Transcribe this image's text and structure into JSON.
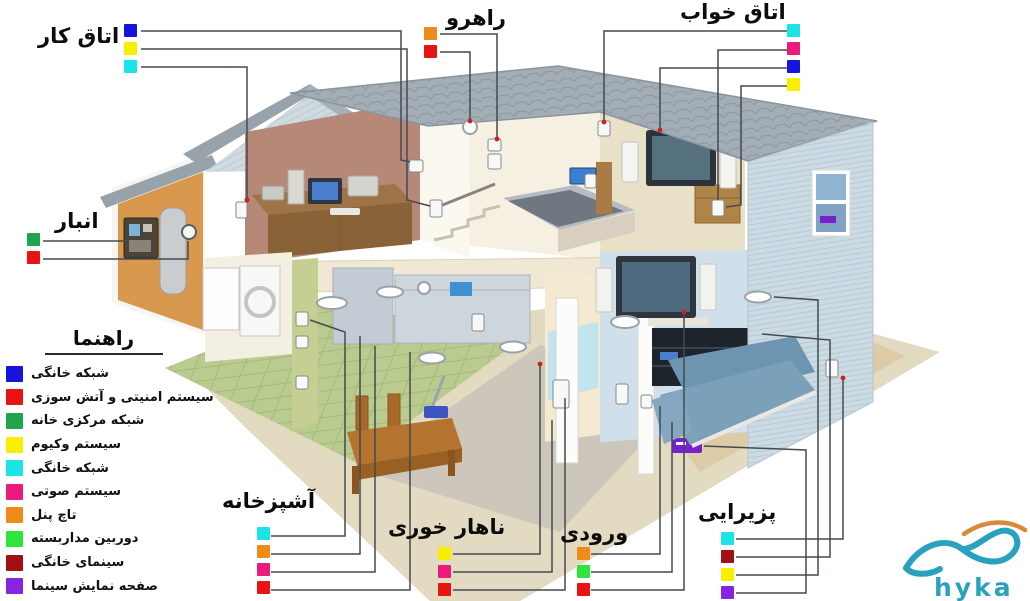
{
  "palette": {
    "blue": "#1414dd",
    "red": "#e81313",
    "green": "#1ea54e",
    "yellow": "#f8ee00",
    "cyan": "#1ae4e4",
    "magenta": "#ea1b7c",
    "orange": "#ef8b1a",
    "brightgreen": "#2fe43c",
    "darkred": "#a11015",
    "purple": "#8824e0"
  },
  "legend": {
    "title": "راهنما",
    "items": [
      {
        "color": "blue",
        "label": "شبکه خانگی"
      },
      {
        "color": "red",
        "label": "سیستم امنیتی و آتش سوزی"
      },
      {
        "color": "green",
        "label": "شبکه مرکزی خانه"
      },
      {
        "color": "yellow",
        "label": "سیستم وکیوم"
      },
      {
        "color": "cyan",
        "label": "شبکه خانگی"
      },
      {
        "color": "magenta",
        "label": "سیستم صوتی"
      },
      {
        "color": "orange",
        "label": "تاچ پنل"
      },
      {
        "color": "brightgreen",
        "label": "دوربین مداربسته"
      },
      {
        "color": "darkred",
        "label": "سینمای خانگی"
      },
      {
        "color": "purple",
        "label": "صفحه نمایش سینما"
      }
    ]
  },
  "rooms": [
    {
      "id": "work-room",
      "label": "اتاق کار",
      "dots": [
        "blue",
        "yellow",
        "cyan"
      ]
    },
    {
      "id": "hallway",
      "label": "راهرو",
      "dots": [
        "orange",
        "red"
      ]
    },
    {
      "id": "bedroom",
      "label": "اتاق خواب",
      "dots": [
        "cyan",
        "magenta",
        "blue",
        "yellow"
      ]
    },
    {
      "id": "storage",
      "label": "انبار",
      "dots": [
        "green",
        "red"
      ]
    },
    {
      "id": "kitchen",
      "label": "آشپزخانه",
      "dots": [
        "cyan",
        "orange",
        "magenta",
        "red"
      ]
    },
    {
      "id": "dining",
      "label": "ناهار خوری",
      "dots": [
        "yellow",
        "magenta",
        "red"
      ]
    },
    {
      "id": "entry",
      "label": "ورودی",
      "dots": [
        "orange",
        "brightgreen",
        "red"
      ]
    },
    {
      "id": "living",
      "label": "پزیرایی",
      "dots": [
        "cyan",
        "darkred",
        "yellow",
        "purple"
      ]
    }
  ],
  "logo": {
    "text": "hyka",
    "color": "#2aa2bd",
    "accent": "#d88a3a"
  }
}
